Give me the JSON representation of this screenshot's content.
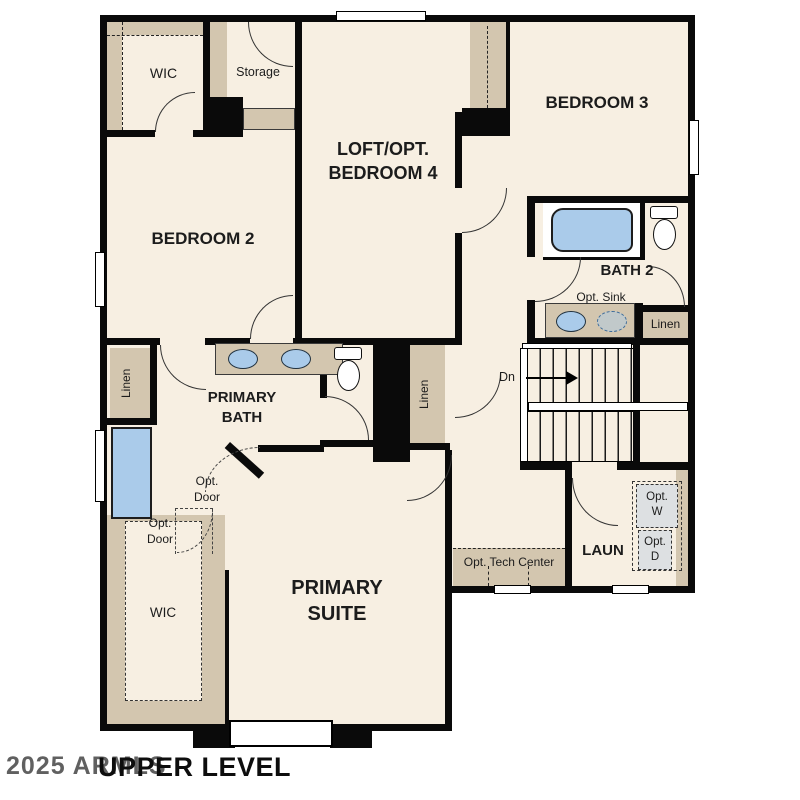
{
  "plan": {
    "title": "UPPER LEVEL",
    "watermark": "2025 ARMLS",
    "rooms": {
      "wic_upper": "WIC",
      "storage": "Storage",
      "bedroom2": "BEDROOM 2",
      "loft_line1": "LOFT/OPT.",
      "loft_line2": "BEDROOM 4",
      "bedroom3": "BEDROOM 3",
      "bath2": "BATH 2",
      "primary_bath_line1": "PRIMARY",
      "primary_bath_line2": "BATH",
      "primary_suite_line1": "PRIMARY",
      "primary_suite_line2": "SUITE",
      "wic_lower": "WIC",
      "laundry": "LAUN"
    },
    "labels": {
      "opt_sink": "Opt. Sink",
      "linen": "Linen",
      "down": "Dn",
      "opt": "Opt.",
      "door": "Door",
      "washer": "W",
      "dryer": "D",
      "tech_center": "Opt. Tech Center"
    },
    "colors": {
      "floor": "#f7efe2",
      "cabinet": "#d3c6af",
      "wall": "#000000",
      "fixture_blue": "#aacbea",
      "appliance_gray": "#dde0e2"
    }
  }
}
